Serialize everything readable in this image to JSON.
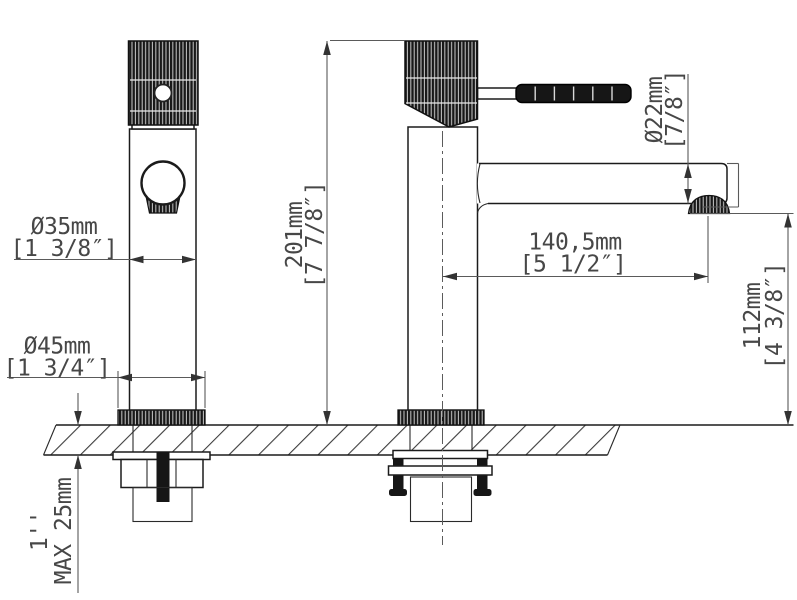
{
  "dimensions": {
    "body_diameter": {
      "metric": "Ø35mm",
      "imperial": "[1 3/8″]"
    },
    "base_diameter": {
      "metric": "Ø45mm",
      "imperial": "[1 3/4″]"
    },
    "total_height": {
      "metric": "201mm",
      "imperial": "[7 7/8″]"
    },
    "spout_diameter": {
      "metric": "Ø22mm",
      "imperial": "[7/8″]"
    },
    "spout_reach": {
      "metric": "140,5mm",
      "imperial": "[5 1/2″]"
    },
    "spout_height": {
      "metric": "112mm",
      "imperial": "[4 3/8″]"
    },
    "deck_thickness": {
      "imperial": "1''",
      "metric": "MAX 25mm"
    }
  }
}
